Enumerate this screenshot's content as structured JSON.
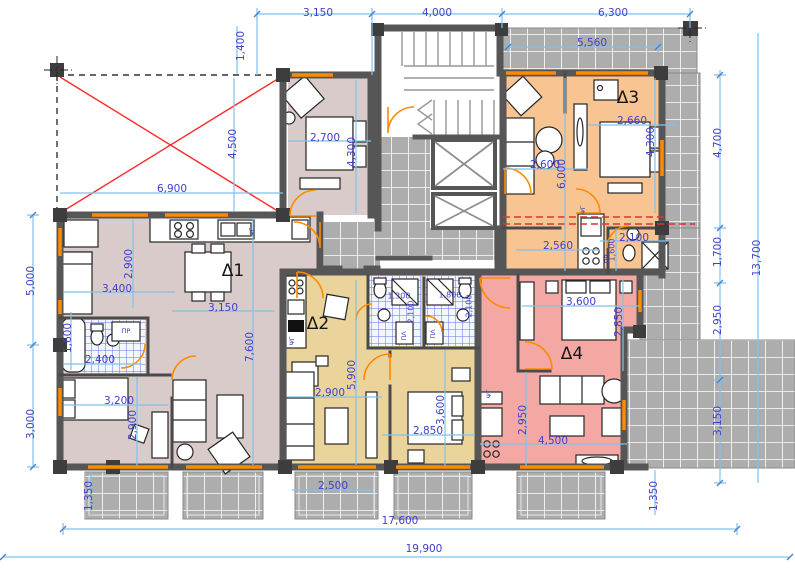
{
  "drawing": {
    "kind_label": "floor-plan"
  },
  "colors": {
    "dimline": "#7fc2ec",
    "dimtext": "#4040cc",
    "wall": "#565656",
    "tile": "#adadad",
    "red": "#ff2a2a",
    "accent": "#ff8a00"
  },
  "apartments": [
    {
      "id": "d1",
      "label": "Δ1",
      "fill": "#d9cbc9"
    },
    {
      "id": "d2",
      "label": "Δ2",
      "fill": "#ebd49c"
    },
    {
      "id": "d3",
      "label": "Δ3",
      "fill": "#f8c492"
    },
    {
      "id": "d4",
      "label": "Δ4",
      "fill": "#f3a8a3"
    }
  ],
  "labels": [
    {
      "text": "3,150",
      "x": 318,
      "y": 13
    },
    {
      "text": "4,000",
      "x": 437,
      "y": 13
    },
    {
      "text": "6,300",
      "x": 613,
      "y": 13
    },
    {
      "text": "5,560",
      "x": 592,
      "y": 43
    },
    {
      "text": "1,400",
      "x": 241,
      "y": 46,
      "r": 1
    },
    {
      "text": "4,500",
      "x": 233,
      "y": 144,
      "r": 1
    },
    {
      "text": "5,000",
      "x": 31,
      "y": 281,
      "r": 1
    },
    {
      "text": "3,000",
      "x": 31,
      "y": 424,
      "r": 1
    },
    {
      "text": "1,350",
      "x": 89,
      "y": 496,
      "r": 1
    },
    {
      "text": "1,350",
      "x": 654,
      "y": 496,
      "r": 1
    },
    {
      "text": "4,700",
      "x": 718,
      "y": 143,
      "r": 1
    },
    {
      "text": "1,700",
      "x": 718,
      "y": 252,
      "r": 1
    },
    {
      "text": "2,950",
      "x": 718,
      "y": 320,
      "r": 1
    },
    {
      "text": "3,150",
      "x": 718,
      "y": 421,
      "r": 1
    },
    {
      "text": "13,700",
      "x": 757,
      "y": 258,
      "r": 1
    },
    {
      "text": "2,500",
      "x": 333,
      "y": 486
    },
    {
      "text": "17,600",
      "x": 400,
      "y": 521
    },
    {
      "text": "19,900",
      "x": 424,
      "y": 549
    },
    {
      "text": "6,900",
      "x": 172,
      "y": 189
    },
    {
      "text": "2,700",
      "x": 325,
      "y": 138
    },
    {
      "text": "4,300",
      "x": 352,
      "y": 152,
      "r": 1
    },
    {
      "text": "2,900",
      "x": 129,
      "y": 264,
      "r": 1
    },
    {
      "text": "3,400",
      "x": 117,
      "y": 289
    },
    {
      "text": "3,150",
      "x": 223,
      "y": 308
    },
    {
      "text": "7,600",
      "x": 250,
      "y": 347,
      "r": 1
    },
    {
      "text": "1,600",
      "x": 68,
      "y": 338,
      "r": 1
    },
    {
      "text": "2,400",
      "x": 100,
      "y": 360
    },
    {
      "text": "3,200",
      "x": 119,
      "y": 401
    },
    {
      "text": "2,900",
      "x": 133,
      "y": 425,
      "r": 1
    },
    {
      "text": "2,900",
      "x": 330,
      "y": 393
    },
    {
      "text": "5,900",
      "x": 352,
      "y": 375,
      "r": 1
    },
    {
      "text": "2,850",
      "x": 428,
      "y": 431
    },
    {
      "text": "3,600",
      "x": 441,
      "y": 410,
      "r": 1
    },
    {
      "text": "1,300",
      "x": 399,
      "y": 296,
      "k": "sm"
    },
    {
      "text": "2,100",
      "x": 411,
      "y": 312,
      "r": 1,
      "k": "sm"
    },
    {
      "text": "1,800",
      "x": 450,
      "y": 295,
      "k": "sm"
    },
    {
      "text": "2,100",
      "x": 469,
      "y": 306,
      "r": 1,
      "k": "sm"
    },
    {
      "text": "2,660",
      "x": 632,
      "y": 121
    },
    {
      "text": "4,300",
      "x": 651,
      "y": 142,
      "r": 1
    },
    {
      "text": "2,600",
      "x": 545,
      "y": 165
    },
    {
      "text": "6,000",
      "x": 562,
      "y": 174,
      "r": 1
    },
    {
      "text": "2,560",
      "x": 558,
      "y": 246
    },
    {
      "text": "2,100",
      "x": 634,
      "y": 238
    },
    {
      "text": "1,600",
      "x": 612,
      "y": 250,
      "r": 1,
      "k": "sm"
    },
    {
      "text": "3,600",
      "x": 581,
      "y": 302
    },
    {
      "text": "2,850",
      "x": 619,
      "y": 322,
      "r": 1
    },
    {
      "text": "2,950",
      "x": 523,
      "y": 420,
      "r": 1
    },
    {
      "text": "4,500",
      "x": 553,
      "y": 441
    },
    {
      "text": "Δ1",
      "x": 233,
      "y": 271,
      "k": "apt"
    },
    {
      "text": "Δ2",
      "x": 318,
      "y": 324,
      "k": "apt"
    },
    {
      "text": "Δ3",
      "x": 628,
      "y": 98,
      "k": "apt"
    },
    {
      "text": "Δ4",
      "x": 572,
      "y": 354,
      "k": "apt"
    },
    {
      "text": "ΠΡ",
      "x": 126,
      "y": 331,
      "k": "fix"
    },
    {
      "text": "ΠΡ",
      "x": 607,
      "y": 259,
      "r": 1,
      "k": "fix"
    },
    {
      "text": "ΨΓ",
      "x": 252,
      "y": 232,
      "r": 1,
      "k": "fix"
    },
    {
      "text": "ΨΓ",
      "x": 292,
      "y": 341,
      "r": 1,
      "k": "fix"
    },
    {
      "text": "ΨΓ",
      "x": 489,
      "y": 394,
      "r": 1,
      "k": "fix"
    },
    {
      "text": "ΨΓ",
      "x": 583,
      "y": 210,
      "r": 1,
      "k": "fix"
    },
    {
      "text": "ΠΛ",
      "x": 404,
      "y": 336,
      "r": 1,
      "k": "fix"
    },
    {
      "text": "ΠΛ",
      "x": 433,
      "y": 334,
      "r": 1,
      "k": "fix"
    }
  ]
}
